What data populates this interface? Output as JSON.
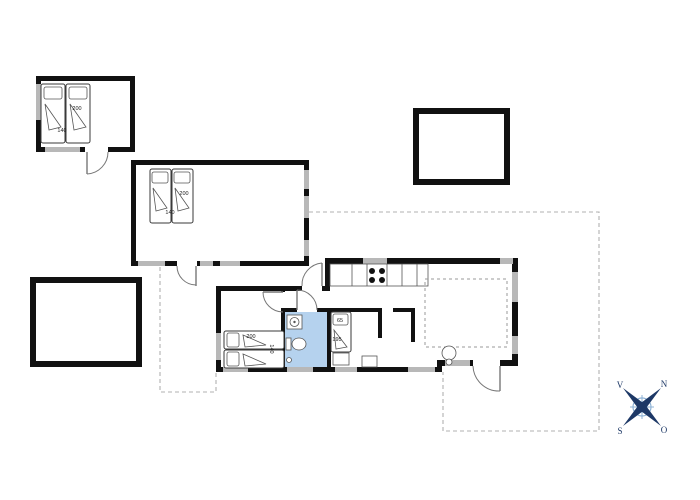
{
  "floorplan": {
    "bed_labels": {
      "annex1_length": "200",
      "annex1_width": "140",
      "annex2_length": "200",
      "annex2_width": "140",
      "main_bedroom_length": "200",
      "main_bedroom_width": "140",
      "small_bedroom_width": "65",
      "small_bedroom_length": "195"
    },
    "compass": {
      "north": "N",
      "west": "V",
      "south": "S",
      "east": "O"
    },
    "colors": {
      "wall": "#111111",
      "window": "#b8b8b8",
      "bathroom_fill": "#b5d2ee",
      "terrace_dash": "#b0b0b0",
      "compass_dark": "#1d3866",
      "compass_light": "#8fb3d6"
    }
  }
}
